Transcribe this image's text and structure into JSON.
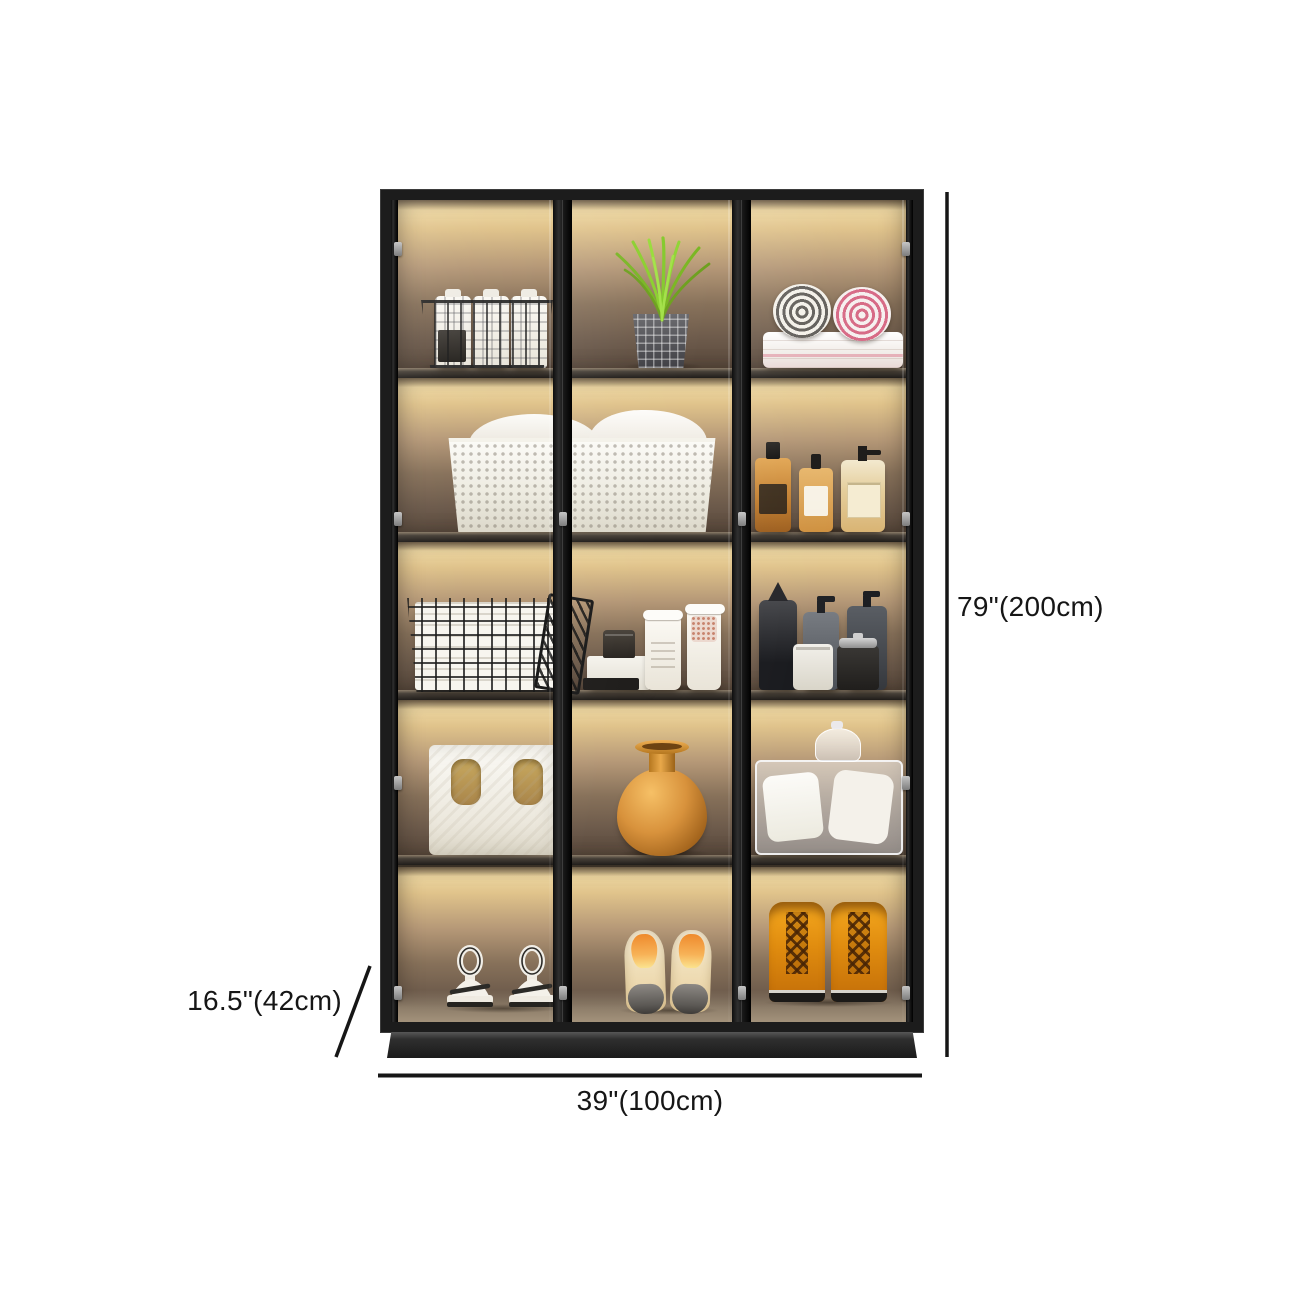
{
  "page": {
    "background": "#ffffff"
  },
  "product": {
    "name": "led-glass-door-display-cabinet",
    "dimensions": {
      "height": "79\"(200cm)",
      "width": "39\"(100cm)",
      "depth": "16.5\"(42cm)"
    },
    "colors": {
      "frame": "#1c1c1c",
      "base": "#262626",
      "led_glow": "#ecd49c",
      "back_panel": "#5d4d40",
      "annotation": "#161616"
    },
    "structure": {
      "glass_doors": 3,
      "columns": 3,
      "rows": 5,
      "lighting": "warm-led-under-shelf"
    },
    "shelf_contents": {
      "row_1": [
        "wire-basket-with-plaid-cartons",
        "green-grass-plant-in-plaid-pot",
        "rolled-towels-on-folded-stack"
      ],
      "row_2": [
        "white-perforated-laundry-basket-with-towels",
        "amber-toiletry-bottles"
      ],
      "row_3": [
        "wire-grid-basket-with-white-books",
        "white-canisters-and-storage-box",
        "black-and-gray-cosmetic-bottles"
      ],
      "row_4": [
        "white-storage-bag-with-handles",
        "terracotta-vase",
        "clear-storage-box-with-linens"
      ],
      "row_5": [
        "white-strappy-platform-heels",
        "beige-cap-toe-pumps",
        "amber-lace-up-boots"
      ]
    }
  }
}
